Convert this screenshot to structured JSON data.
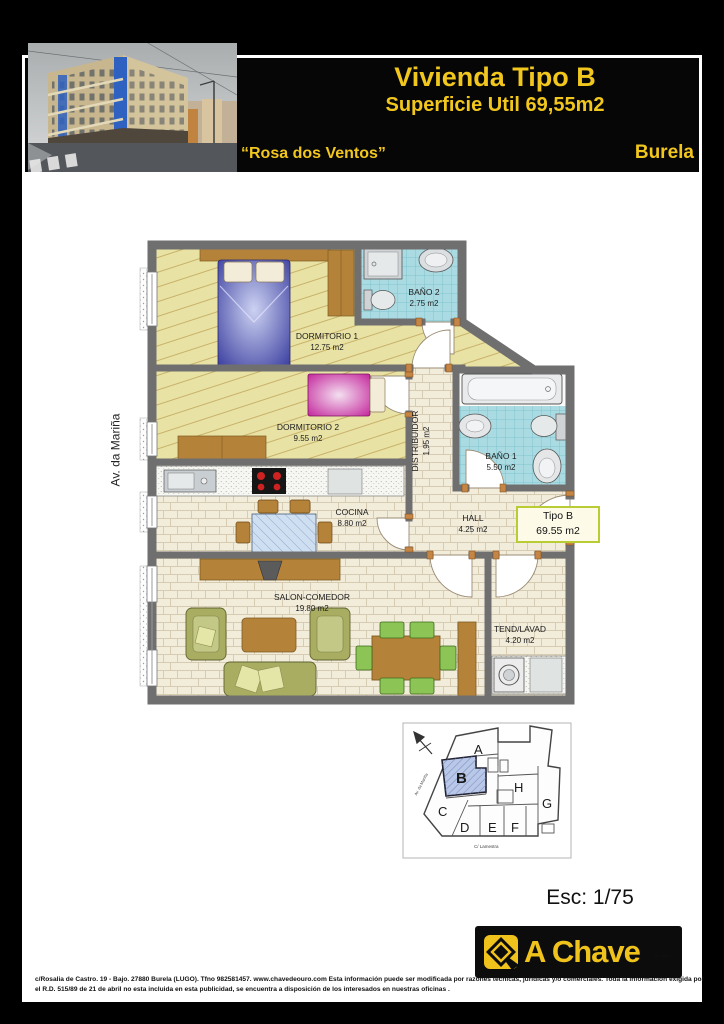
{
  "header": {
    "title": "Vivienda Tipo B",
    "subtitle": "Superficie Util 69,55m2",
    "residence": "“Rosa dos Ventos”",
    "city": "Burela",
    "accent_color": "#f2c71d"
  },
  "street_label": "Av. da Mariña",
  "plan": {
    "wall_color": "#6f6f6f",
    "rooms": [
      {
        "name": "DORMITORIO 1",
        "area": "12.75 m2"
      },
      {
        "name": "BAÑO 2",
        "area": "2.75 m2"
      },
      {
        "name": "DORMITORIO 2",
        "area": "9.55 m2"
      },
      {
        "name": "DISTRIBUIDOR",
        "area": "1.95 m2"
      },
      {
        "name": "BAÑO 1",
        "area": "5.50 m2"
      },
      {
        "name": "COCINA",
        "area": "8.80 m2"
      },
      {
        "name": "HALL",
        "area": "4.25 m2"
      },
      {
        "name": "SALON-COMEDOR",
        "area": "19.80 m2"
      },
      {
        "name": "TEND/LAVAD",
        "area": "4.20 m2"
      }
    ],
    "type_label": {
      "name": "Tipo B",
      "area": "69.55 m2"
    }
  },
  "keyplan": {
    "units": [
      "A",
      "B",
      "C",
      "D",
      "E",
      "F",
      "G",
      "H"
    ],
    "highlighted_unit": "B",
    "highlight_color": "#b9c8e8",
    "street_left": "Av. da Mariña",
    "street_bottom": "C/ Lamestra"
  },
  "scale_label": "Esc: 1/75",
  "logo": {
    "name": "A Chave",
    "sub": "de ouro"
  },
  "footer": {
    "line1": "c/Rosalia de Castro. 19 - Bajo. 27880 Burela (LUGO). Tfno 982581457.    www.chavedeouro.com  Esta información puede ser modificada por razones técnicas, jurídicas y/o comerciales. Toda la información exigida por",
    "line2": "el R.D. 515/89 de 21 de abril no esta incluida en esta publicidad, se encuentra a disposición de los interesados en nuestras oficinas ."
  }
}
